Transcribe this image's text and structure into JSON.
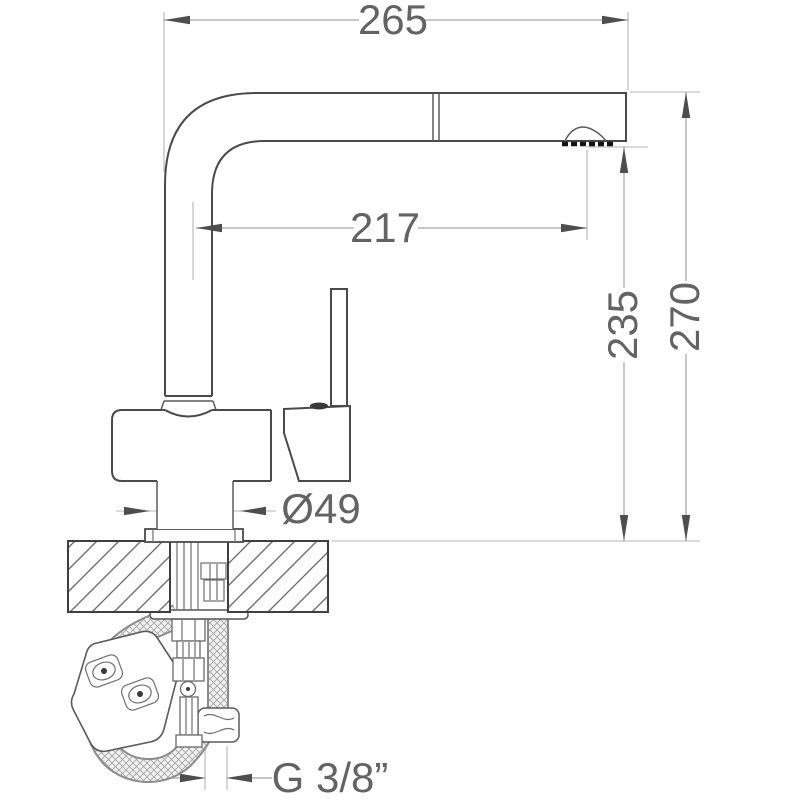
{
  "drawing": {
    "subject": "pull-out kitchen faucet technical drawing",
    "palette": {
      "background": "#ffffff",
      "outline": "#4a4a4a",
      "dimension_line": "#a3a3a3",
      "label_text": "#636363",
      "aerator": "#151515"
    }
  },
  "labels": {
    "reach_overall": "265",
    "reach_to_outlet": "217",
    "outlet_height": "235",
    "overall_height": "270",
    "base_diameter": "Ø49",
    "thread_size": "G 3/8”"
  }
}
